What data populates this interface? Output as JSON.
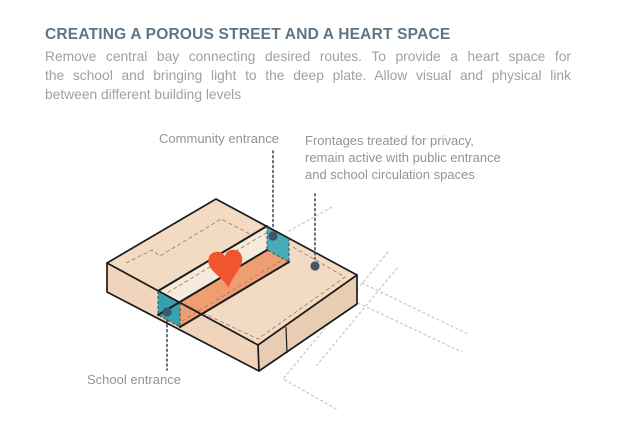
{
  "header": {
    "title": "CREATING A POROUS STREET AND A HEART SPACE",
    "description_lines": [
      "Remove central bay connecting desired routes. To provide a heart space for",
      "the school and bringing light to the deep plate. Allow visual and physical link",
      "between different building levels"
    ]
  },
  "diagram": {
    "labels": {
      "community": "Community entrance",
      "frontages": "Frontages treated for privacy, remain active with public entrance and school circulation spaces",
      "school": "School entrance"
    },
    "icons": {
      "heart": "heart-icon",
      "entrance_dot": "entrance-dot"
    },
    "colors": {
      "title_text": "#5E7586",
      "body_text": "#9AA2A7",
      "label_text": "#8D969B",
      "face_top": "#F3DAC3",
      "face_sw": "#F0D5BC",
      "face_se": "#E9CDB2",
      "wall_cream": "#F5EADC",
      "floor_orange": "#EF9E73",
      "wall_teal_school": "#35A2AF",
      "wall_teal_community": "#48ACB8",
      "heart": "#F1552D",
      "outline": "#1C1C1C",
      "dashed_brown": "#A5846A",
      "route_gray": "#CBCBCB",
      "leader_navy": "#44596C",
      "dot_navy": "#41566A"
    }
  }
}
